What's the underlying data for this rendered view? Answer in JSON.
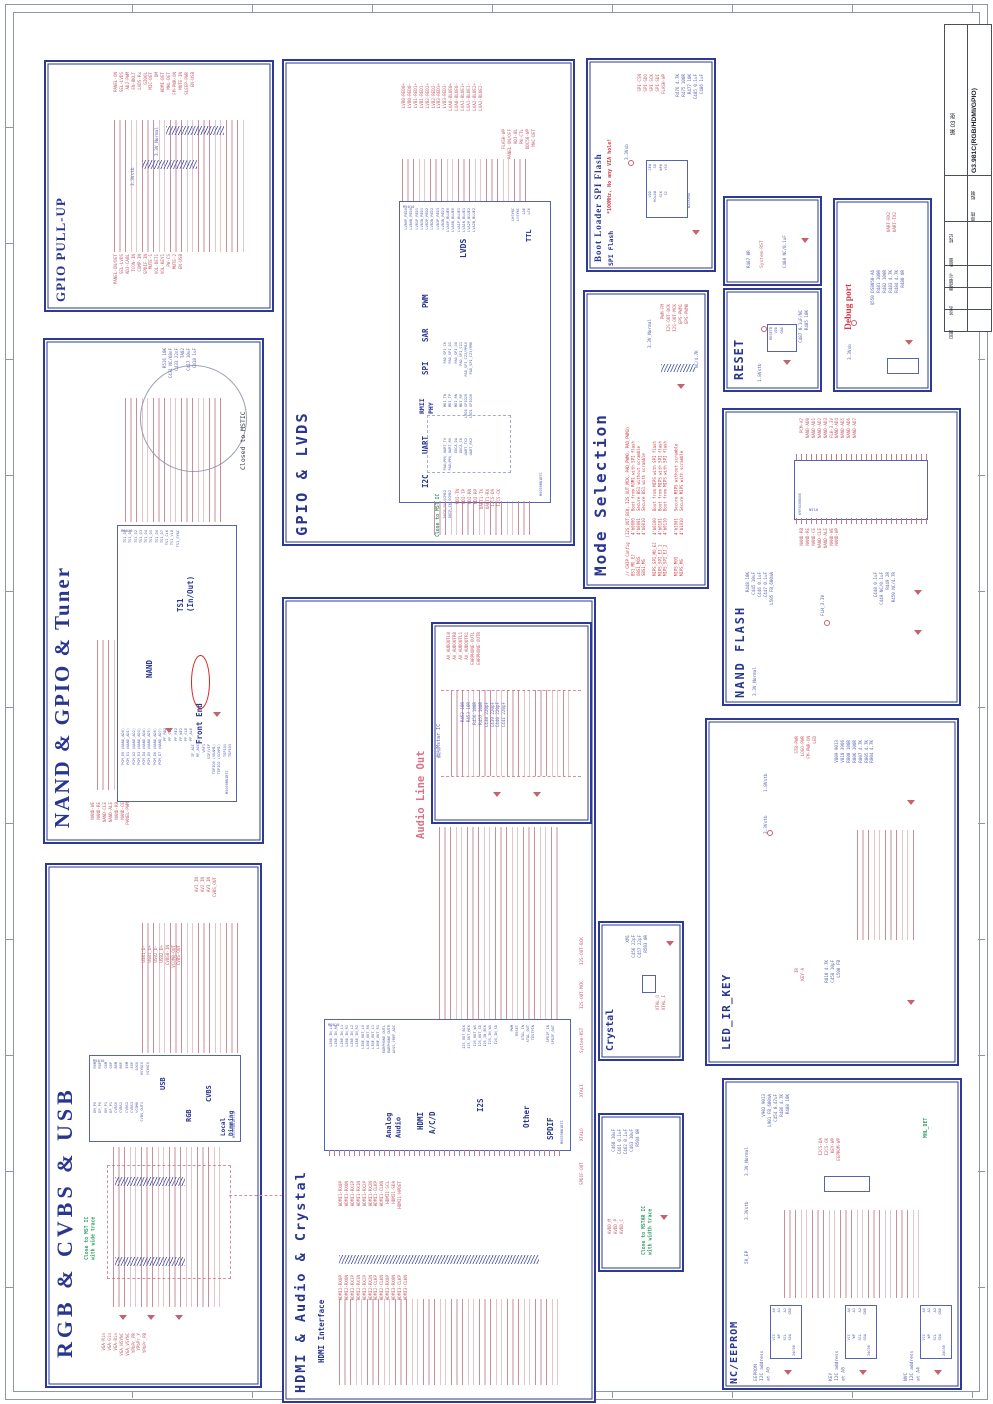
{
  "sheet": {
    "code": "G3.981C(RGB/HDMI/GPIO)",
    "sheet_no": "第 03 张",
    "field_draft": "拟制",
    "field_check": "审核",
    "fields_bottom": [
      "标记",
      "数量",
      "更改单号",
      "签名",
      "日期"
    ]
  },
  "panels": {
    "gpio_pullup": {
      "title": "GPIO PULL-UP",
      "rail_a": "3.3V_Normal",
      "rail_b": "3.3Vstb",
      "signals_top": [
        "PANEL-ON",
        "SEL-LVDS",
        "ADJ-PWM",
        "EN-BKLT",
        "LVDS-Rx",
        "GI06L",
        "MIC-DET",
        "DM",
        "HDMI-DET",
        "MHL-DET",
        "FM-PWR-ON",
        "MUTE-IN",
        "SLEEP-PWR",
        "EN-USB"
      ],
      "signals_bottom": [
        "PANEL-ON/DET",
        "SEL-LVDS",
        "ADJ-CABL",
        "TCON-IN",
        "COMP-IN",
        "SPDIF-IN",
        "MUTE-1",
        "VOL-DET1",
        "VOL-KEY1",
        "PW-CS",
        "MUTE-2",
        "EN-USB"
      ]
    },
    "nand_gpio_tuner": {
      "title": "NAND & GPIO & Tuner",
      "ic_ref": "M5010",
      "ic_part": "M5059BN1BTC",
      "block_ts1": "TS1\n(In/Out)",
      "block_nand": "NAND",
      "block_fe": "Front End",
      "note_mstic": "Closed to MSTIC",
      "pins_ts1": [
        "TS1_D0",
        "TS1_D1",
        "TS1_D2",
        "TS1_D3",
        "TS1_D4",
        "TS1_D5",
        "TS1_D6",
        "TS1_D7",
        "TS1_CLK",
        "TS1_VLD",
        "TS1_SYNC"
      ],
      "pins_nand": [
        "PCM_D0 (NAND_AD0)",
        "PCM_D1 (NAND_AD1)",
        "PCM_D2 (NAND_AD2)",
        "PCM_D3 (NAND_AD3)",
        "PCM_D4 (NAND_AD4)",
        "PCM_D5 (NAND_AD5)",
        "PCM_D6 (NAND_AD6)",
        "PCM_D7 (NAND_AD7)",
        "PF_RB2",
        "PF_CE2",
        "PF_RE2",
        "PF_WE2",
        "PF_CLE",
        "PF_ALE"
      ],
      "pins_fe": [
        "IF_AGC",
        "RF_AGC",
        "VRF1",
        "SIF/VIF",
        "TGPIO0 (SDAM1)",
        "TGPIO2 (SCKM1)",
        "TGPIO1",
        "TGPIO3"
      ],
      "signals_left": [
        "NAND-WE",
        "NAND-RE",
        "NAND-CLE",
        "NAND-ALE",
        "NAND-RB",
        "NAND-CE",
        "PANEL-PWM"
      ],
      "parts": [
        "R516 10K",
        "C431 NC/68nF",
        "C433 22nF",
        "TA02",
        "C417 10uF",
        "C418 1uF"
      ]
    },
    "rgb_cvbs_usb": {
      "title": "RGB & CVBS & USB",
      "note": "Close to MST IC\nwith wide trace",
      "ic_ref": "M5010",
      "ic_part": "M5059BN1BTC",
      "block_usb": "USB",
      "block_rgb": "RGB",
      "block_cvbs": "CVBS",
      "block_ld": "Local\nDimming",
      "pins_top": [
        "R0M",
        "R0P",
        "G0M",
        "G0P",
        "B0M",
        "B0P",
        "E0M",
        "E0P",
        "SOG0",
        "HSYNC0",
        "VSYNC0"
      ],
      "pins_mid": [
        "DM_P0",
        "DP_P0",
        "DM_P1",
        "DP_P1",
        "CVBS0",
        "CVBS1",
        "CVBS2",
        "CVBS3",
        "VCOM8",
        "CVBS_OUT1"
      ],
      "signals_usb": [
        "USB1_D-",
        "USB1_D+",
        "USB2_D-",
        "USB2_D+",
        "CVBS0-IN",
        "VCOM8-OUT",
        "CVBS-OUT"
      ],
      "signals_av": [
        "AV1_IN",
        "AV2_IN",
        "AV3_IN",
        "CVBS_OUT"
      ],
      "connectors": [
        "VGA-Rin",
        "VGA-Gin",
        "VGA-Bin",
        "VGA_HSYNC",
        "VGA_VSYNC",
        "YPbPr_PR",
        "YPbPr_Y",
        "YPbPr_PB"
      ]
    },
    "gpio_lvds": {
      "title": "GPIO & LVDS",
      "ic_ref": "M5010",
      "ic_part": "M5059BN1BTC",
      "block_lvds": "LVDS",
      "block_ttl": "TTL",
      "block_pwm": "PWM",
      "block_sar": "SAR",
      "block_spi": "SPI",
      "block_rmii": "RMII\nPHY",
      "block_uart": "UART",
      "block_i2c": "I2C",
      "pins_lvds": [
        "LVB0P_RED0",
        "LVB0N_RED0",
        "LVB1P_RED1",
        "LVB1N_RED1",
        "LVB2P_RED2",
        "LVB2N_RED2",
        "LVB3P_RED3",
        "LVB3N_RED3",
        "LVA0P_BLUE0",
        "LVA0N_BLUE0",
        "LVA1P_BLUE1",
        "LVA1N_BLUE1",
        "LVA2P_BLUE2",
        "LVA2N_BLUE2"
      ],
      "pins_ttl": [
        "LHSYNC",
        "LVSYNC",
        "LDE",
        "LCK"
      ],
      "pins_spi": [
        "PAD_SPI_CK",
        "PAD_SPI_DI",
        "PAD_SPI_DO",
        "PAD_SPI_CZ1",
        "PAD_SPI_CZ2/PM10",
        "PAD_SPI_CZ3/PM8"
      ],
      "pins_rmii": [
        "MDI_TN",
        "MDI_TP",
        "MDI_RN",
        "MDI_RP",
        "LED0 GPIO29",
        "LED1 GPIO30"
      ],
      "pins_uart": [
        "PAD(PM)_UART_TX",
        "PAD(PM)_UART_RX",
        "DDCA_DA",
        "DDCA_CK",
        "UART_TX2",
        "UART_RX2"
      ],
      "pins_i2c": [
        "DDCR_DA SCM02",
        "DDCR_CK SCM02"
      ],
      "nets_top": [
        "LVB0-RED0+",
        "LVB0-RED0-",
        "LVB1-RED1+",
        "LVB1-RED1-",
        "LVB2-RED2+",
        "LVB2-RED2-",
        "LVB3-RED3+",
        "LVB3-RED3-",
        "LVA0-BLUE0+",
        "LVA0-BLUE0-",
        "LVA1-BLUE1+",
        "LVA1-BLUE1-",
        "LVA2-BLUE2+",
        "LVA2-BLUE2-"
      ],
      "nets_right": [
        "FLASH-WP",
        "PANEL-ON/OFF",
        "ADJ-BL",
        "PW-CTL",
        "DDC50-WP",
        "MAC-DET"
      ],
      "nets_bottom": [
        "MDI-TN",
        "MDI-TP",
        "MDI-RN",
        "MDI-RP",
        "UART1-TX",
        "UART1-RX",
        "I2CS-DA",
        "I2CS-CK"
      ],
      "note": "Close to MST IC"
    },
    "hdmi_audio_crystal": {
      "title": "HDMI & Audio & Crystal",
      "subtitle": "HDMI Interface",
      "audio_title": "Audio Line Out",
      "ic_ref": "M9010",
      "ic_part": "M5059BN1BTC",
      "block_audio": "Analog\nAudio",
      "block_hdmi": "HDMI",
      "block_acd": "A/C/D",
      "block_i2s": "I2S",
      "block_other": "Other",
      "block_spdif": "SPDIF",
      "pins_audio": [
        "LINE_IN_L0",
        "LINE_IN_R0",
        "LINE_IN_L1",
        "LINE_IN_R1",
        "LINE_IN_L2",
        "LINE_IN_R2",
        "LINE_OUT_L0",
        "LINE_OUT_R0",
        "LINE_OUT_L1",
        "LINE_OUT_R1",
        "EARPHONE_OUTL",
        "EARPHONE_OUTR",
        "AVSS_VREF_ADC"
      ],
      "pins_i2s": [
        "I2S_OUT_BCK",
        "I2S_OUT_MCK",
        "I2S_OUT_WS",
        "I2S_OUT_SD",
        "I2S_IN_BCK",
        "I2S_IN_WS",
        "I2S_IN_SD"
      ],
      "pins_other": [
        "PWM",
        "RESET",
        "XTAL_IN",
        "XTAL_OUT",
        "TESTPIN"
      ],
      "pins_spdif": [
        "SPDIF_IN",
        "SPDIF_OUT"
      ],
      "nets_hdmi1": [
        "HDMI1-RX0P",
        "HDMI1-RX0N",
        "HDMI1-RX1P",
        "HDMI1-RX1N",
        "HDMI1-RX2P",
        "HDMI1-RX2N",
        "HDMI1-CLKP",
        "HDMI1-CLKN",
        "HDMI1-SCL",
        "HDMI1-SDA",
        "HDMI1-HPDET"
      ],
      "nets_hdmi23": [
        "HDMI2-RX0P",
        "HDMI2-RX0N",
        "HDMI2-RX1P",
        "HDMI2-RX1N",
        "HDMI2-RX2P",
        "HDMI2-RX2N",
        "HDMI2-CLKP",
        "HDMI2-CLKN",
        "HDMI3-RX0P",
        "HDMI3-RX0N",
        "HDMI3-CLKP",
        "HDMI3-CLKN"
      ],
      "nets_right": [
        "I2S-OUT-BCK",
        "I2S-OUT-MCK",
        "System-RST",
        "XTALI",
        "XTALO",
        "SPDIF-OUT"
      ]
    },
    "audio_line_out": {
      "note_cn": "靠近Mstar IC",
      "signals": [
        "AV_AUDOUTL0",
        "AV_AUDOUTR0",
        "AV_AUDOUTL1",
        "AV_AUDOUTR1",
        "EARPHONE-OUTL",
        "EARPHONE-OUTR"
      ],
      "parts": [
        "R452 10R",
        "R453 10R",
        "R456 100R",
        "R457 100R",
        "C438 220pF",
        "C439 220pF",
        "C440 220pF",
        "C441 220pF"
      ]
    },
    "mode_selection": {
      "title": "Mode Selection",
      "config_text": "// CHIP Config  (I2S_OUT_BCK, I2S_OUT_MCK, PAD_PWM0, PAD_PWM3)\nBS1_MO_EJ        4'b0000   Boot from ROM1 with SPI flash\nOBS1_MOS         4'b0001   Secure BS1 without scramble\nSBS1_MS          4'b0010   Secure BS1 with scramble\n\nMIPS_SPI_MO_EJ   4'b0100   Boot from MIPS with SPI flash\nMIPS_SPI_EJ_1    4'b0101   Boot from MIPS with SPI flash\nMIPS_SPI_EJ_2    4'b0110   Boot from MIPS with SPI flash\n\nMIPS_MOS         4'b1001   Secure MIPS without scramble\nMIPS_MS          4'b1010   Secure MIPS with scramble",
      "straps": [
        "PWM-FM",
        "I2S-OUT-BCK",
        "I2S-OUT-MCK",
        "GPS-PWM1",
        "GPS-PWM0"
      ],
      "res_value": "NC/4.7K",
      "rail": "3.3V_Normal"
    },
    "boot_loader": {
      "title": "Boot Loader SPI Flash",
      "subtitle": "SPI Flash",
      "note": "*100MHz, No any VIA hole!",
      "ic_part": "W25X80A",
      "pins_l": [
        "CE#",
        "SO",
        "WP#",
        "VSS"
      ],
      "pins_r": [
        "VDD",
        "HOLD#",
        "SCK",
        "SI"
      ],
      "signals": [
        "SPI-CSN",
        "SPI-SDO",
        "SPI-SCK",
        "SPI-SDI",
        "FLASH-WP"
      ],
      "parts": [
        "R476 4.7K",
        "R475 100R",
        "R477 10K",
        "C485 0.1uF",
        "C486 1uF"
      ],
      "rail": "3.3Vsb"
    },
    "system_rst": {
      "signal": "System-RST",
      "part_a": "R487 0R",
      "part_b": "C488 NC/0.1uF"
    },
    "reset": {
      "title": "RESET",
      "pins": [
        "RESETB",
        "VDD",
        "GND"
      ],
      "parts": [
        "C487 0.1uF/NC",
        "R485 10K"
      ],
      "rail": "1.8Vstb"
    },
    "debug_port": {
      "title": "Debug port",
      "signals": [
        "UART-RX2",
        "UART-TX2"
      ],
      "parts": [
        "Q550 DS8050-A6",
        "R481 100R",
        "R482 100R",
        "R483 4.7K",
        "R484 4.7K",
        "R480 0R"
      ],
      "rail": "3.3Vsb"
    },
    "nand_flash": {
      "title": "NAND FLASH",
      "ic_part": "K9F4G08U0B",
      "ic_ref": "N510",
      "nets_top": [
        "PCM-A7",
        "NAND-AD0",
        "NAND-AD1",
        "NAND-AD2",
        "NAND-AD3",
        "FLH-3.3V",
        "NAND-AD4",
        "NAND-AD5",
        "NAND-AD6",
        "NAND-AD7"
      ],
      "nets_bottom": [
        "NAND-RB",
        "NAND-RE",
        "NAND-CE",
        "NAND-CLE",
        "NAND-ALE",
        "NAND-WE",
        "NAND-WP"
      ],
      "parts_l": [
        "R448 10K",
        "C445 10uF",
        "C446 0.1uF",
        "C447 0.1uF",
        "L505 FB_600mA"
      ],
      "parts_r": [
        "C448 0.1uF",
        "C449 NC/0.1uF",
        "R449 2R",
        "R450 NC/4.7R"
      ],
      "rail_a": "FLH_3.3V",
      "rail_b": "3.3V_Normal"
    },
    "led_ir_key": {
      "title": "LED_IR_KEY",
      "signals": [
        "STB-PWR",
        "LOGO-PWR",
        "FM-PWR-ON",
        "LED"
      ],
      "parts": [
        "V809 9013",
        "V810 3906",
        "R808 100R",
        "R806 100R",
        "R807 4.7K",
        "R805 4.7K",
        "R804 4.7K"
      ],
      "signals2": [
        "IR",
        "KEY-A"
      ],
      "parts2": [
        "R810 4.7K",
        "C458 10pF",
        "L508 FB"
      ],
      "rails": [
        "1.8Vstb",
        "3.3Vstb"
      ]
    },
    "nc_eeprom": {
      "title": "NC/EEPROM",
      "ic_part": "24C08",
      "group1": "EEPROM\nI2C address\nat A0",
      "group2": "KEY\nI2C address\nat A8",
      "group3": "NVC\nI2C address\nat A4",
      "pins_l": [
        "A0",
        "A1",
        "A2",
        "GND"
      ],
      "pins_r": [
        "VCC",
        "WP",
        "SCL",
        "SDA"
      ],
      "signals": [
        "I2CS-DA",
        "I2CS-CK",
        "KEY-WP",
        "EEPROM-WP"
      ],
      "parts": [
        "V902 9013",
        "L901 FB_600mA",
        "C454 0.47uF",
        "R486 4.7K",
        "R488 10K"
      ],
      "net_green": "MHL_DET",
      "rails": [
        "3.3V_Normal",
        "3.3Vstb",
        "5V_EP"
      ]
    },
    "crystal": {
      "title": "Crystal",
      "parts": [
        "XM1",
        "C456 22pF",
        "C457 22pF",
        "R503 0R"
      ],
      "signals": [
        "XTAL_O",
        "XTAL_I"
      ]
    },
    "avdd_filter": {
      "note": "Close to MSTAR IC\nwith width trace",
      "parts": [
        "C460 10uF",
        "C461 0.1uF",
        "C462 0.1uF",
        "C463 10uF",
        "R504 0R"
      ],
      "signals": [
        "AVDD_M",
        "AVDD_P",
        "AVDD_C"
      ]
    }
  }
}
